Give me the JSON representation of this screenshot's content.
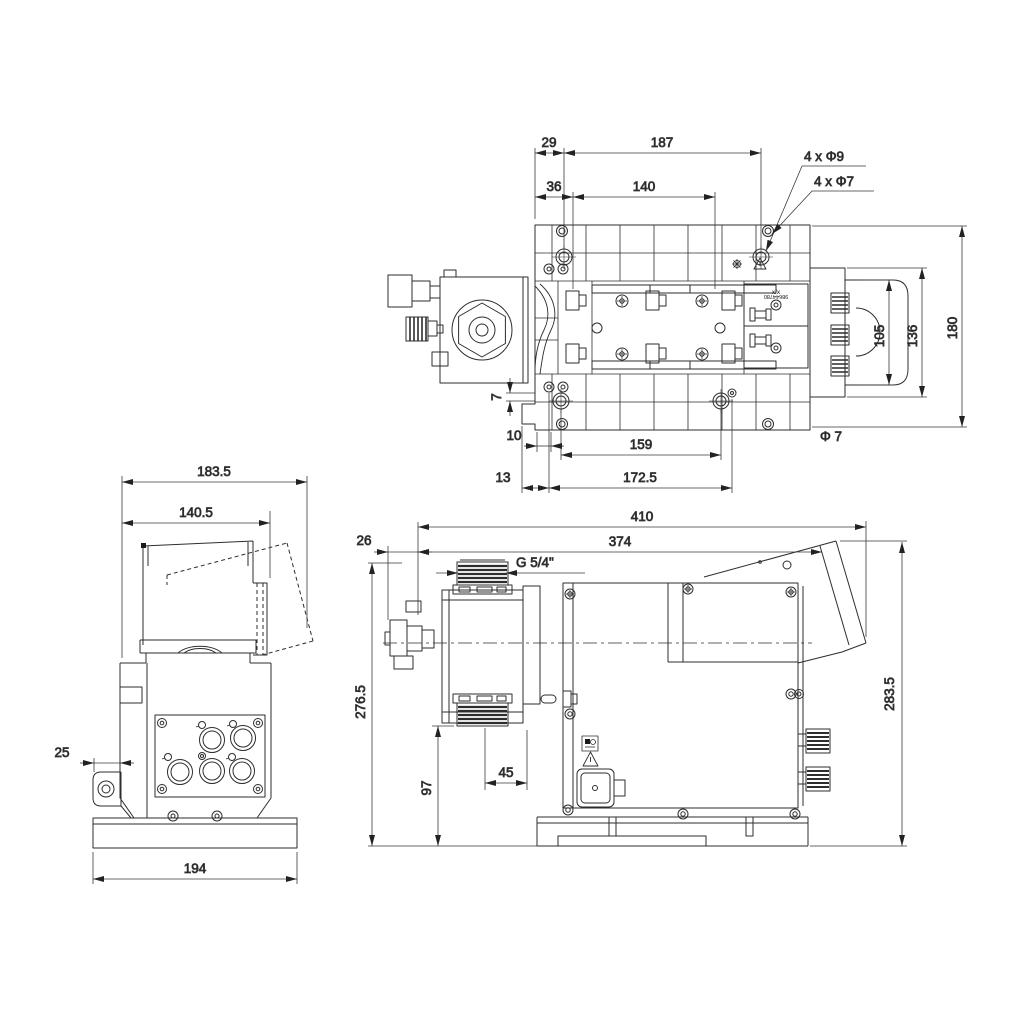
{
  "meta": {
    "drawing_type": "pump dimensional drawing",
    "background": "#ffffff",
    "line_color": "#2d2d2d",
    "dim_color": "#333333"
  },
  "top_view": {
    "dims": {
      "left_offset": "29",
      "hole_span": "187",
      "inner_offset": "36",
      "slot_span": "140",
      "holes_large": "4 x Φ9",
      "holes_small": "4 x Φ7",
      "cap_width": "105",
      "cover_width": "136",
      "plate_depth": "180",
      "edge_gap": "7",
      "bottom_offset": "10",
      "bottom_span": "159",
      "hole_dia": "Φ 7",
      "base_offset": "13",
      "outer_span": "172.5"
    },
    "labels": {
      "marking": "x/x",
      "serial": "98644780"
    }
  },
  "front_view": {
    "dims": {
      "overall_width": "183.5",
      "body_width": "140.5",
      "bracket_depth": "25",
      "base_width": "194"
    }
  },
  "side_view": {
    "dims": {
      "overall_length": "410",
      "body_length": "374",
      "head_offset": "26",
      "thread": "G 5/4\"",
      "height_front": "276.5",
      "height_back": "283.5",
      "port_height": "97",
      "port_offset": "45"
    }
  }
}
